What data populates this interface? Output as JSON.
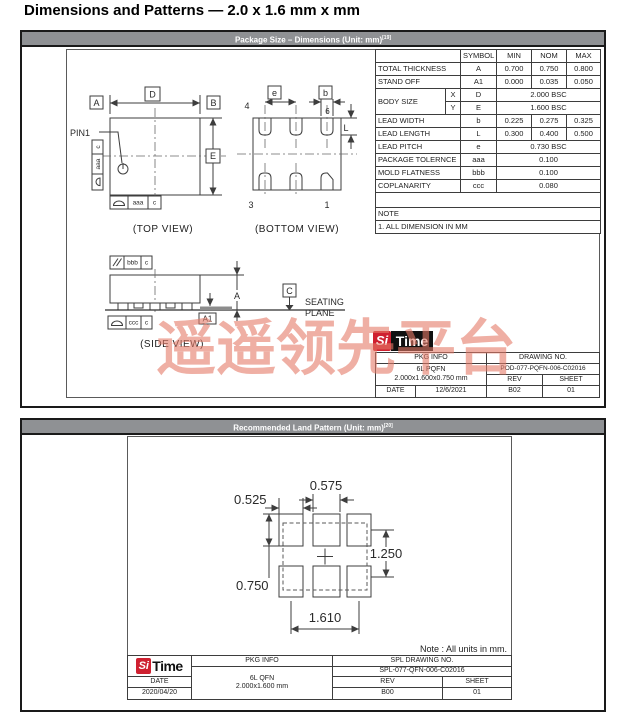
{
  "page": {
    "title": "Dimensions and Patterns — 2.0 x 1.6 mm x mm"
  },
  "watermark": {
    "text": "遥遥领先平台",
    "color": "#e47a68"
  },
  "colors": {
    "header_bar": "#8f9194",
    "logo_red": "#cf2030",
    "line": "#3d3d3d"
  },
  "section1": {
    "header": {
      "text": "Package Size – Dimensions (Unit: mm)",
      "superscript": "[19]"
    },
    "top_view": {
      "label": "(TOP VIEW)",
      "pin1_label": "PIN1",
      "dim_a": "A",
      "dim_b": "B",
      "dim_d": "D",
      "dim_e": "E",
      "frame_left": {
        "cell1": "c",
        "cell2": "aaa",
        "symbol": "surface-profile"
      },
      "frame_bottom": {
        "cell1": "aaa",
        "cell2": "c",
        "symbol": "surface-profile"
      }
    },
    "bottom_view": {
      "label": "(BOTTOM VIEW)",
      "dim_e": "e",
      "dim_b": "b",
      "dim_l": "L",
      "pin4": "4",
      "pin6": "6",
      "pin3": "3",
      "pin1": "1"
    },
    "side_view": {
      "label": "(SIDE VIEW)",
      "frame_top": {
        "cell1": "//",
        "cell2": "bbb",
        "cell3": "c",
        "symbol": "parallelism"
      },
      "frame_bottom": {
        "cell1": "ccc",
        "cell2": "c",
        "symbol": "surface-profile"
      },
      "dim_a1": "A1",
      "dim_a": "A",
      "datum_c": "C",
      "seating_line1": "SEATING",
      "seating_line2": "PLANE"
    },
    "table": {
      "headers": {
        "symbol": "SYMBOL",
        "min": "MIN",
        "nom": "NOM",
        "max": "MAX"
      },
      "rows": [
        {
          "param": "TOTAL THICKNESS",
          "symbol": "A",
          "min": "0.700",
          "nom": "0.750",
          "max": "0.800"
        },
        {
          "param": "STAND OFF",
          "symbol": "A1",
          "min": "0.000",
          "nom": "0.035",
          "max": "0.050"
        },
        {
          "param": "BODY SIZE",
          "sub_x": "X",
          "symbol_x": "D",
          "span_x": "2.000 BSC",
          "sub_y": "Y",
          "symbol_y": "E",
          "span_y": "1.600 BSC"
        },
        {
          "param": "LEAD WIDTH",
          "symbol": "b",
          "min": "0.225",
          "nom": "0.275",
          "max": "0.325"
        },
        {
          "param": "LEAD LENGTH",
          "symbol": "L",
          "min": "0.300",
          "nom": "0.400",
          "max": "0.500"
        },
        {
          "param": "LEAD PITCH",
          "symbol": "e",
          "span": "0.730 BSC"
        },
        {
          "param": "PACKAGE TOLERNCE",
          "symbol": "aaa",
          "span": "0.100"
        },
        {
          "param": "MOLD FLATNESS",
          "symbol": "bbb",
          "span": "0.100"
        },
        {
          "param": "COPLANARITY",
          "symbol": "ccc",
          "span": "0.080"
        }
      ],
      "note_label": "NOTE",
      "note1": "1. ALL DIMENSION IN MM"
    },
    "title_block": {
      "logo_si": "Si",
      "logo_time": "Time",
      "pkg_info_label": "PKG INFO",
      "pkg_line1": "6L PQFN",
      "pkg_line2": "2.000x1.600x0.750 mm",
      "drawing_no_label": "DRAWING NO.",
      "drawing_no": "POD-077-PQFN-006-C02016",
      "date_label": "DATE",
      "date": "12/6/2021",
      "rev_label": "REV",
      "rev": "B02",
      "sheet_label": "SHEET",
      "sheet": "01"
    }
  },
  "section2": {
    "header": {
      "text": "Recommended Land Pattern (Unit: mm)",
      "superscript": "[20]"
    },
    "dims": {
      "pad_width_center": "0.575",
      "pad_width_outer": "0.525",
      "pad_height": "0.750",
      "row_span": "1.250",
      "outer_span": "1.610"
    },
    "note": "Note : All units in mm.",
    "title_block": {
      "logo_si": "Si",
      "logo_time": "Time",
      "pkg_info_label": "PKG INFO",
      "pkg_line1": "6L QFN",
      "pkg_line2": "2.000x1.600 mm",
      "drawing_no_label": "SPL DRAWING NO.",
      "drawing_no": "SPL-077-QFN-006-C02016",
      "date_label": "DATE",
      "date": "2020/04/20",
      "rev_label": "REV",
      "rev": "B00",
      "sheet_label": "SHEET",
      "sheet": "01"
    }
  }
}
